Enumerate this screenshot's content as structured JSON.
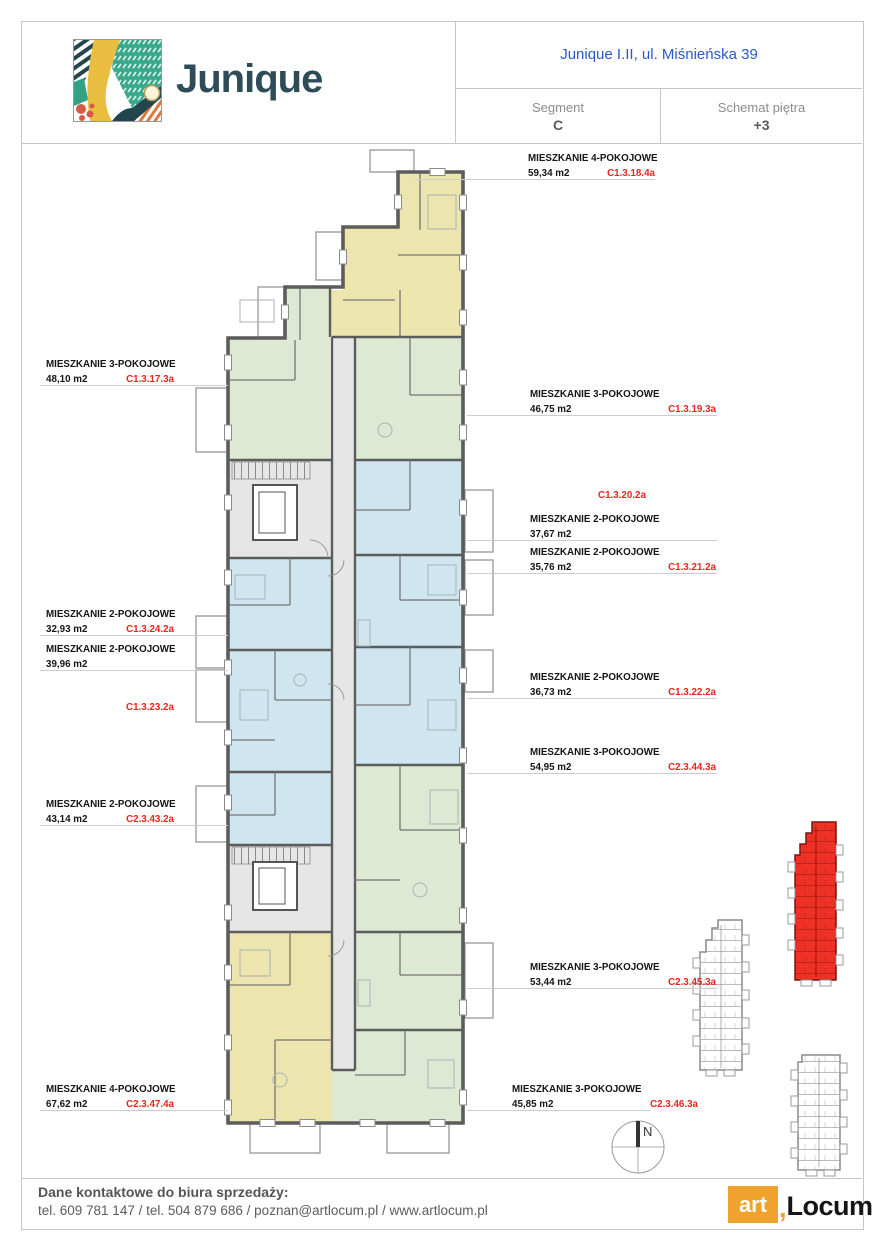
{
  "header": {
    "brand": "Junique",
    "project_title": "Junique I.II, ul. Miśnieńska 39",
    "segment": {
      "label": "Segment",
      "value": "C"
    },
    "floor": {
      "label": "Schemat piętra",
      "value": "+3"
    }
  },
  "plan": {
    "apartments": {
      "c1_3_17": {
        "type": "MIESZKANIE 3-POKOJOWE",
        "area": "48,10 m2",
        "code": "C1.3.17.3a"
      },
      "c1_3_18": {
        "type": "MIESZKANIE 4-POKOJOWE",
        "area": "59,34 m2",
        "code": "C1.3.18.4a"
      },
      "c1_3_19": {
        "type": "MIESZKANIE 3-POKOJOWE",
        "area": "46,75 m2",
        "code": "C1.3.19.3a"
      },
      "c1_3_20": {
        "type": "MIESZKANIE 2-POKOJOWE",
        "area": "37,67 m2",
        "code": "C1.3.20.2a"
      },
      "c1_3_21": {
        "type": "MIESZKANIE 2-POKOJOWE",
        "area": "35,76 m2",
        "code": "C1.3.21.2a"
      },
      "c1_3_22": {
        "type": "MIESZKANIE 2-POKOJOWE",
        "area": "36,73 m2",
        "code": "C1.3.22.2a"
      },
      "c1_3_23": {
        "type": "MIESZKANIE 2-POKOJOWE",
        "area": "39,96 m2",
        "code": "C1.3.23.2a"
      },
      "c1_3_24": {
        "type": "MIESZKANIE 2-POKOJOWE",
        "area": "32,93 m2",
        "code": "C1.3.24.2a"
      },
      "c2_3_43": {
        "type": "MIESZKANIE 2-POKOJOWE",
        "area": "43,14 m2",
        "code": "C2.3.43.2a"
      },
      "c2_3_44": {
        "type": "MIESZKANIE 3-POKOJOWE",
        "area": "54,95 m2",
        "code": "C2.3.44.3a"
      },
      "c2_3_45": {
        "type": "MIESZKANIE 3-POKOJOWE",
        "area": "53,44 m2",
        "code": "C2.3.45.3a"
      },
      "c2_3_46": {
        "type": "MIESZKANIE 3-POKOJOWE",
        "area": "45,85 m2",
        "code": "C2.3.46.3a"
      },
      "c2_3_47": {
        "type": "MIESZKANIE 4-POKOJOWE",
        "area": "67,62 m2",
        "code": "C2.3.47.4a"
      }
    },
    "compass_label": "N"
  },
  "footer": {
    "heading": "Dane kontaktowe do biura sprzedaży:",
    "contact_line": "tel. 609 781 147 / tel. 504 879 686 / poznan@artlocum.pl / www.artlocum.pl",
    "logo": {
      "art": "art",
      "separator": ",",
      "locum": "Locum"
    }
  },
  "colors": {
    "accent_red": "#e8251d",
    "title_blue": "#2a5ac8",
    "apartment_yellow": "#ece5ad",
    "apartment_green": "#dde9d2",
    "apartment_blue": "#cfe5ef",
    "corridor_gray": "#e6e6e6",
    "wall_gray": "#5c5c5c",
    "minimap_highlight_red": "#ee3124",
    "brand_orange": "#f0a32c",
    "brand_dark_teal": "#2e4c57"
  }
}
